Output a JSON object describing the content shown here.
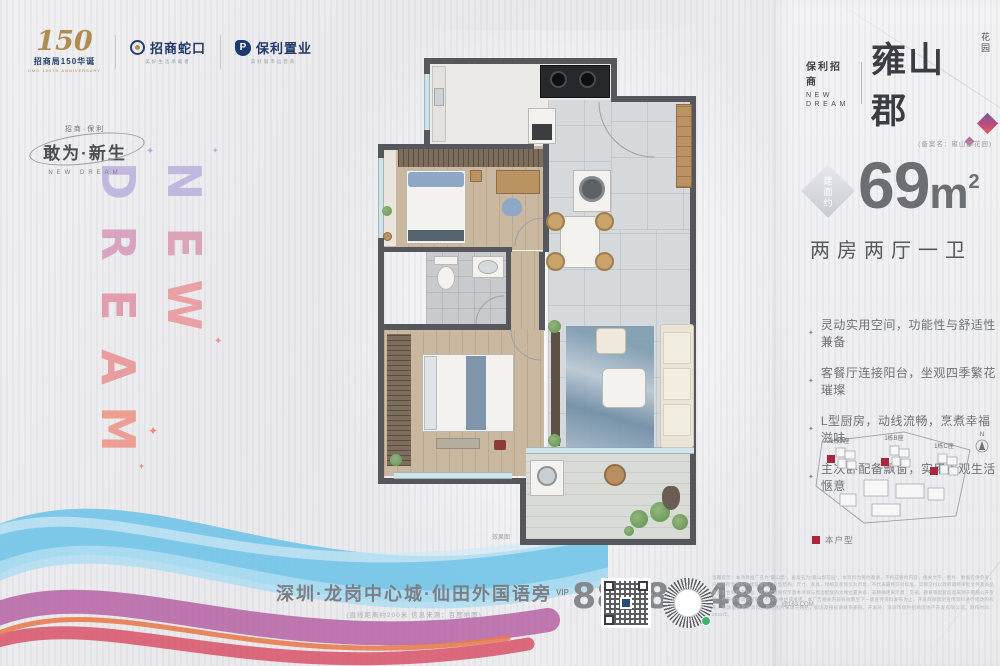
{
  "header_logos": {
    "anniversary": {
      "numeral": "150",
      "line1": "招商局150华诞",
      "line2": "CMG 150TH ANNIVERSARY"
    },
    "cmsk": {
      "name": "招商蛇口",
      "slogan": "美好生活承载者"
    },
    "poly": {
      "initial": "P",
      "name": "保利置业",
      "slogan": "美好城市运营商"
    }
  },
  "brand_left": {
    "tagline_small": "招商·保利",
    "tagline_main": "敢为·新生",
    "tagline_en": "NEW DREAM"
  },
  "watermark": {
    "dream": [
      "D",
      "R",
      "E",
      "A",
      "M"
    ],
    "new": [
      "N",
      "E",
      "W"
    ],
    "sparkle": "✦"
  },
  "project": {
    "brand": "保利招商",
    "brand_en_1": "NEW",
    "brand_en_2": "DREAM",
    "name": "雍山郡",
    "suffix": "花园",
    "filing": "(备案名：雍山郡花园)"
  },
  "unit": {
    "area_badge": "建面约",
    "area_value": "69",
    "area_unit": "m",
    "area_exp": "2",
    "rooms": "两房两厅一卫",
    "features": [
      "灵动实用空间，功能性与舒适性兼备",
      "客餐厅连接阳台，坐观四季繁花璀璨",
      "L型厨房，动线流畅，烹煮幸福滋味",
      "主次卧配备飘窗，实用美观生活惬意"
    ]
  },
  "siteplan": {
    "north_label": "N",
    "buildings": [
      "1栋A座",
      "1栋B座",
      "1栋C座"
    ],
    "legend_label": "本户型"
  },
  "floorplan": {
    "caption": "效果图"
  },
  "footer": {
    "address": "深圳·龙岗中心城·仙田外国语旁",
    "address_note": "(直线距离约200米 信息来源：百度地图)",
    "vip_label": "VIP",
    "phone": "8898 9488",
    "phone_suffix": "@163.COM",
    "fine_print": "温馨提示：本项目推广名为“雍山郡”，备案名为“雍山郡花园”。本资料为要约邀请，不构成要约内容，相关文字、图片、数据仅供参考。户型图所示面积为建筑面积，户型结构、尺寸、家具、绿植及装饰仅为示意，不代表最终交付标准，实际交付以政府最终审批文件及商品房买卖合同约定为准。区位示意图仅示意本项目与周边配套的大致位置关系，非精确距离示意，交通、教育等配套信息来源于网络公开资料，存在规划调整可能，不作为要约或承诺。本广告相关内容有效期至下一版宣传资料发布为止，开发商保留对宣传资料进行修改的权利，敬请留意最新资料。部分图片来源于网络，如涉及侵权请联系删除。开发商：深圳市保利招商房地产开发有限公司。制作时间：2022年。"
  },
  "colors": {
    "accent_red": "#a8273a",
    "navy": "#1f3a6e",
    "gold": "#b08c4e"
  }
}
